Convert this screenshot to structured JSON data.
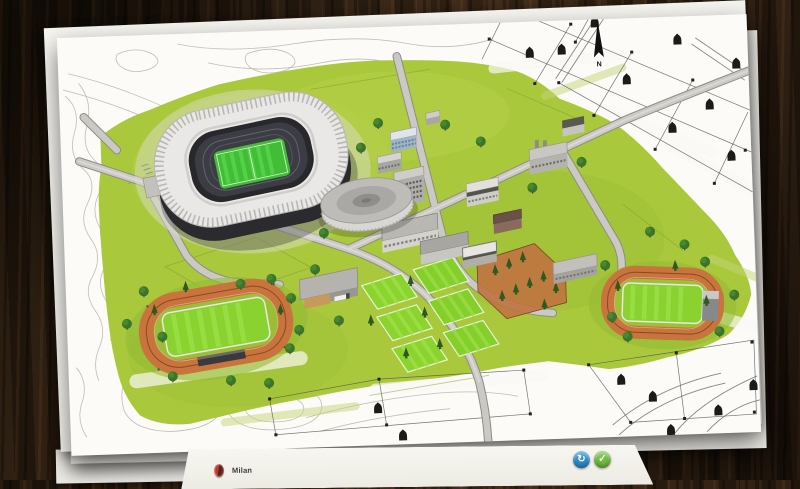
{
  "scene": {
    "description": "club facilities blueprint map laid on a dark wooden desk",
    "desk_color": "#2a1d12",
    "paper_color": "#fcfbf8"
  },
  "map": {
    "compass_label": "N",
    "terrain_green": "#a9c83c",
    "pitch_green": "#7fd32b",
    "track_orange": "#c8713c",
    "road_gray": "#cbc9c4",
    "features": [
      "stadium",
      "indoor-arena",
      "training-pitches",
      "athletics-track-left",
      "athletics-track-right",
      "warehouse",
      "tree-courtyard",
      "cadastral-parcels",
      "contour-lines",
      "north-arrow"
    ]
  },
  "bottom_bar": {
    "club_name": "Milan",
    "continue_button": {
      "glyph": "↻",
      "color": "#2e8fd0"
    },
    "confirm_button": {
      "glyph": "✓",
      "color": "#74bf44"
    }
  }
}
